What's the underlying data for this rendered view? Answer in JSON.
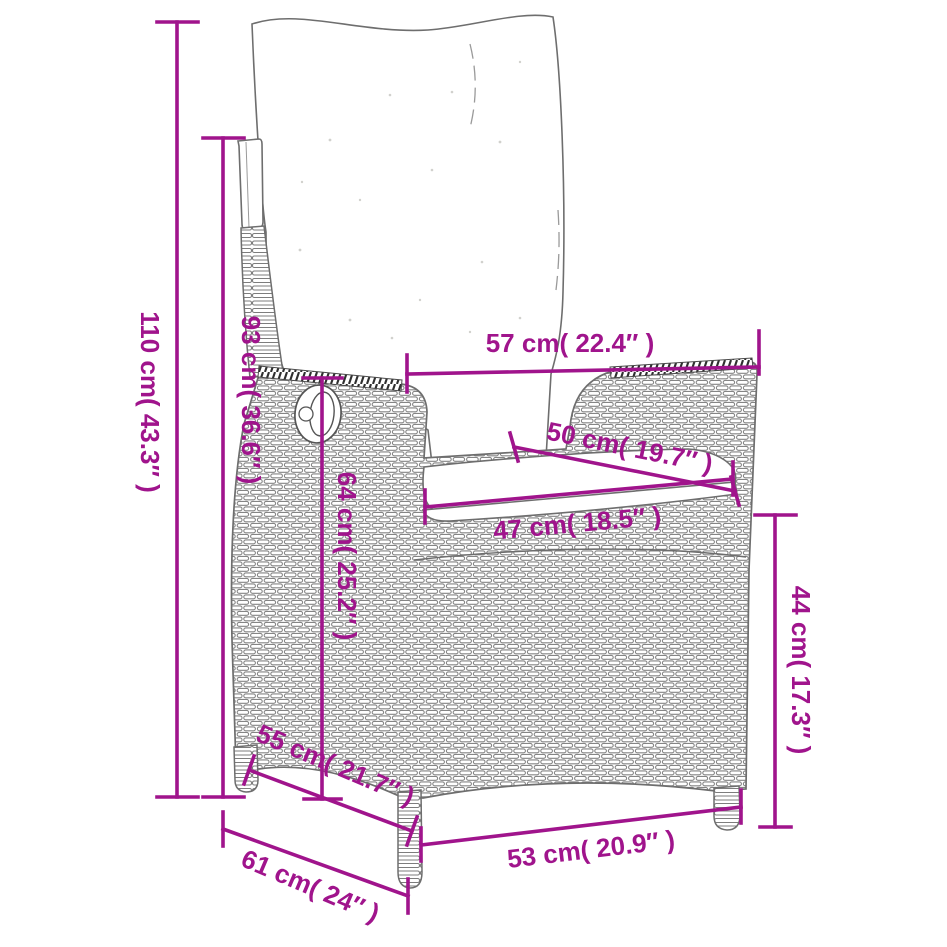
{
  "diagram": {
    "title": "Reclining garden chair with cushions — dimension drawing",
    "accent_color": "#A0148C",
    "line_art_color": "#6e6e6e",
    "background": "#ffffff",
    "unit_primary": "cm",
    "unit_secondary": "inches",
    "dimensions": {
      "total_height": "110 cm( 43.3″ )",
      "backrest_height": "93 cm( 36.6″ )",
      "top_width": "57 cm( 22.4″ )",
      "backrest_width": "50 cm( 19.7″ )",
      "seat_width": "47 cm( 18.5″ )",
      "armrest_height": "64 cm( 25.2″ )",
      "seat_height": "44 cm( 17.3″ )",
      "seat_depth": "55 cm( 21.7″ )",
      "front_width": "53 cm( 20.9″ )",
      "total_depth": "61 cm( 24″ )"
    }
  }
}
